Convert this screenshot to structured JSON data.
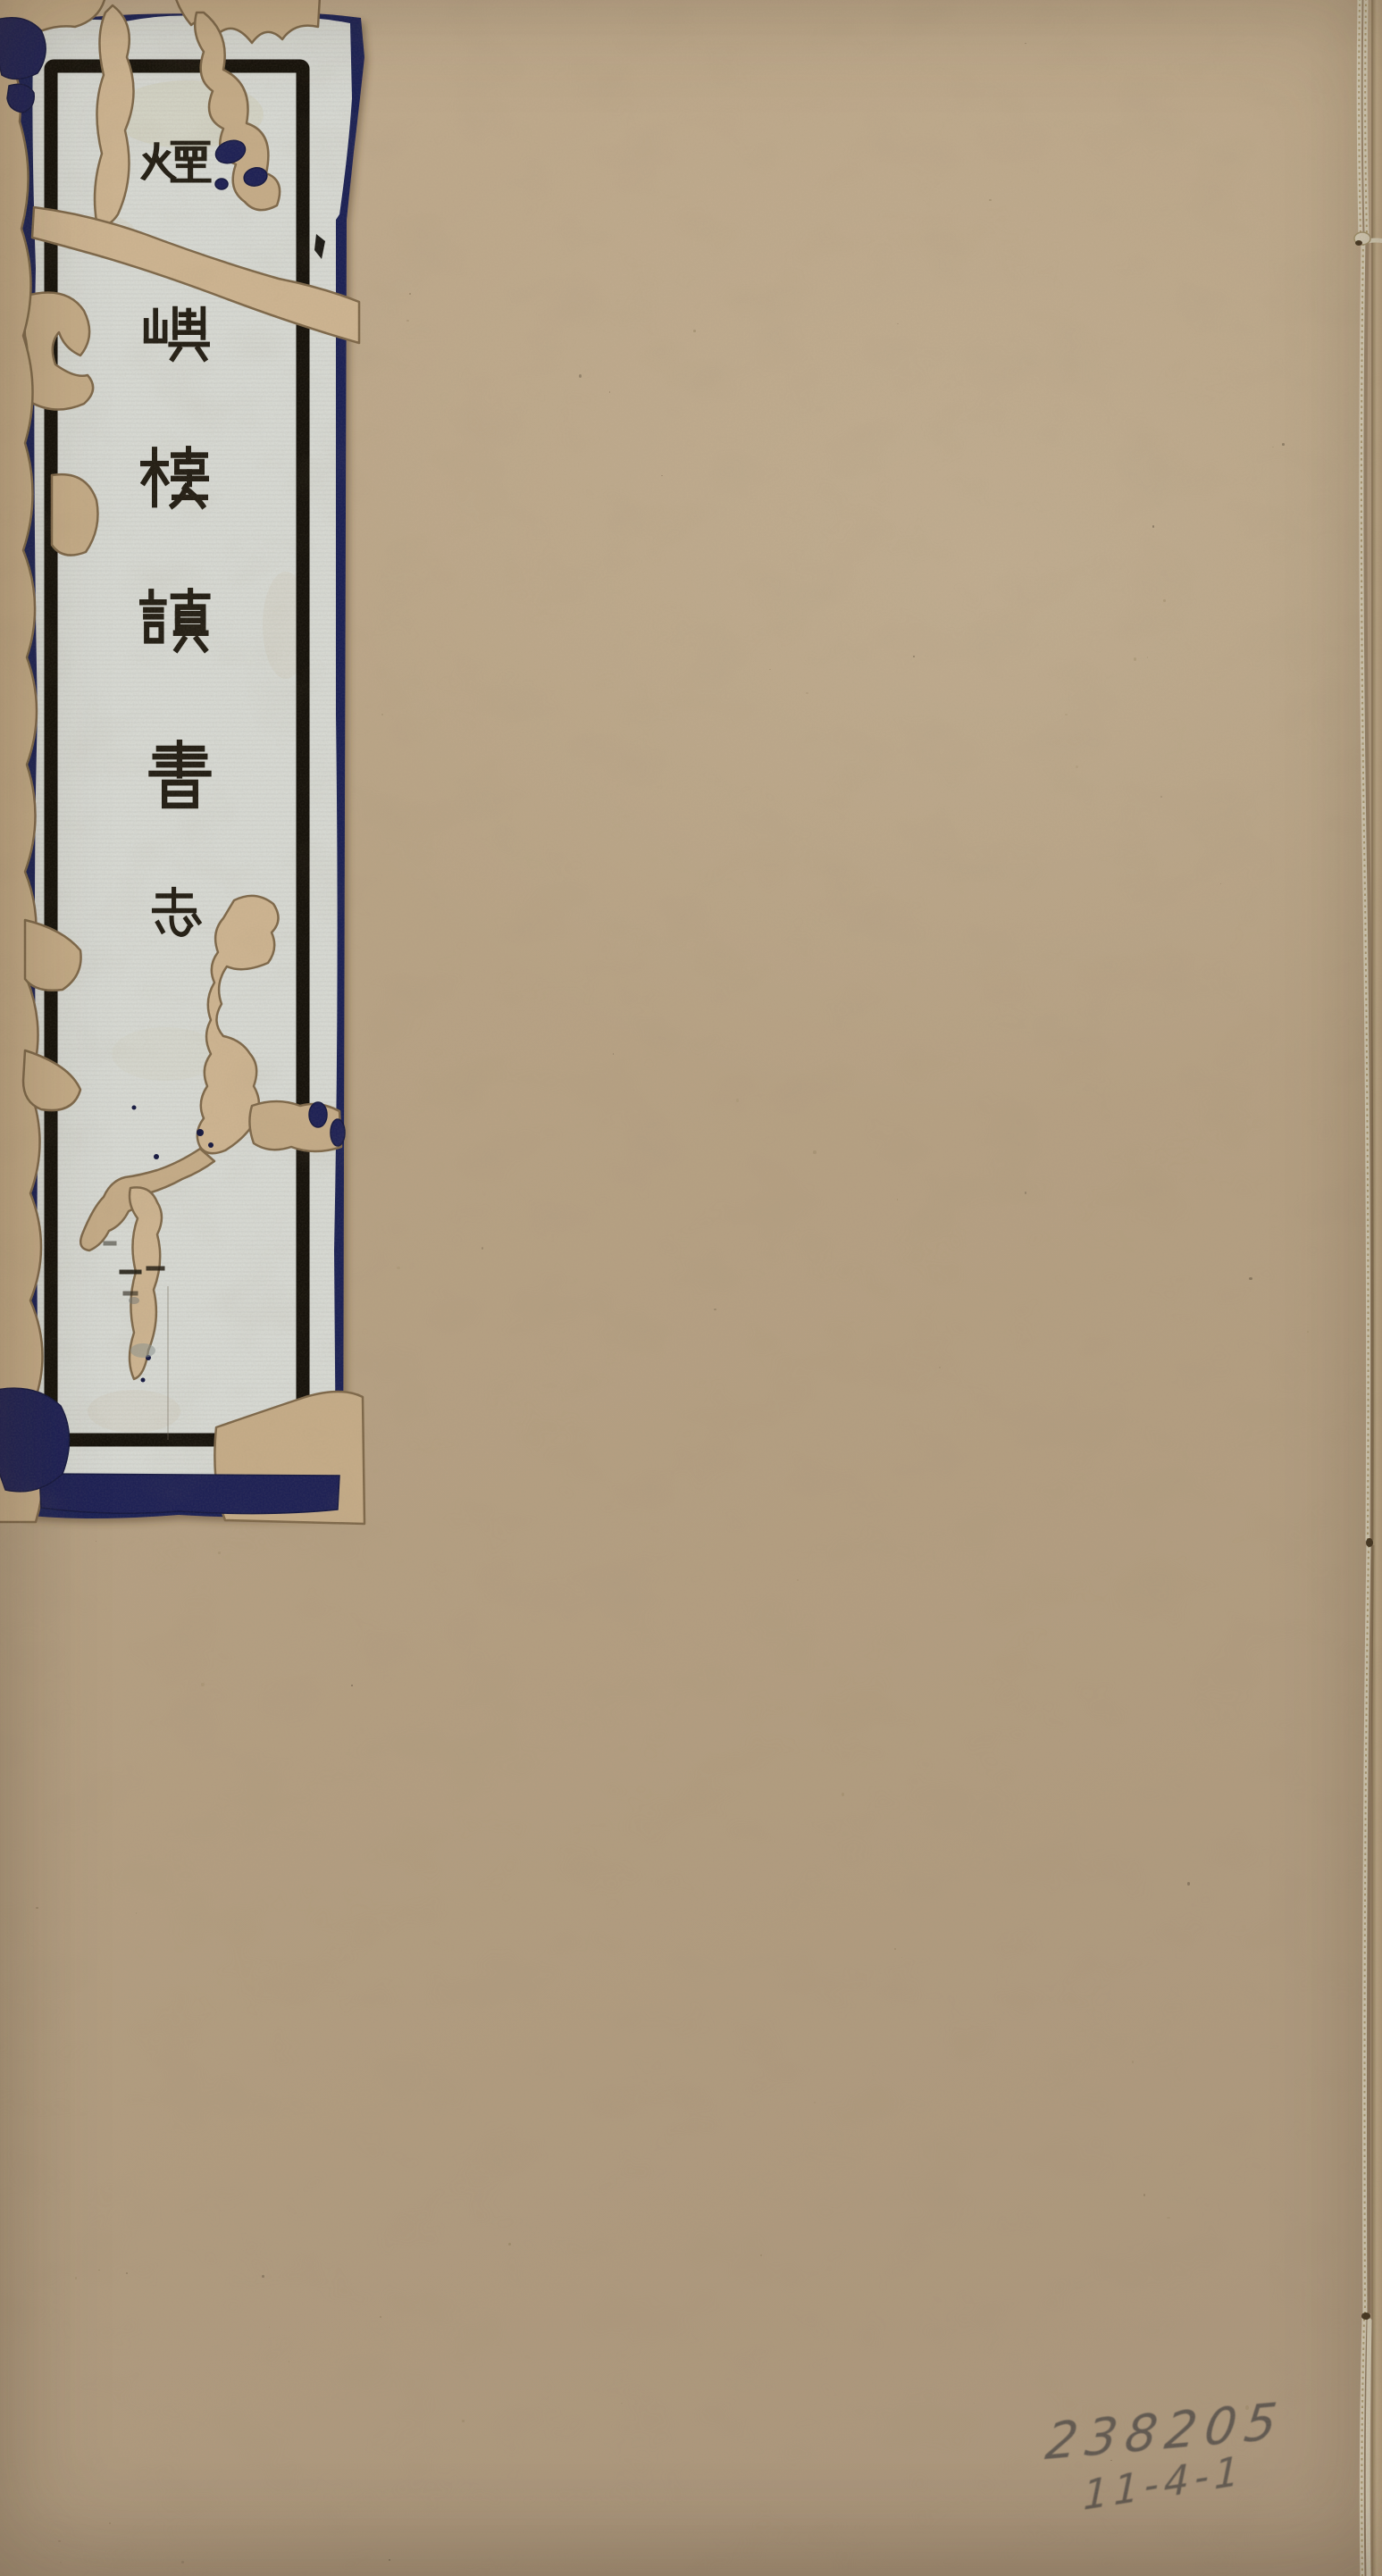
{
  "title_label": {
    "title": "煙嶼樓讀書志",
    "chars": [
      "煙",
      "嶼",
      "樓",
      "讀",
      "書",
      "志"
    ],
    "volume_marker": "一"
  },
  "annotations": {
    "accession_number": "238205",
    "shelf_mark": "11-4-1"
  },
  "colors": {
    "cover": "#b5a083",
    "label_paper": "#d6d8d2",
    "backing_blue": "#1f2255",
    "frame_black": "#17130c",
    "ink": "#241f15",
    "tear_fill": "#c4ab87",
    "pencil": "#55504a",
    "thread": "#dcd4bd"
  }
}
